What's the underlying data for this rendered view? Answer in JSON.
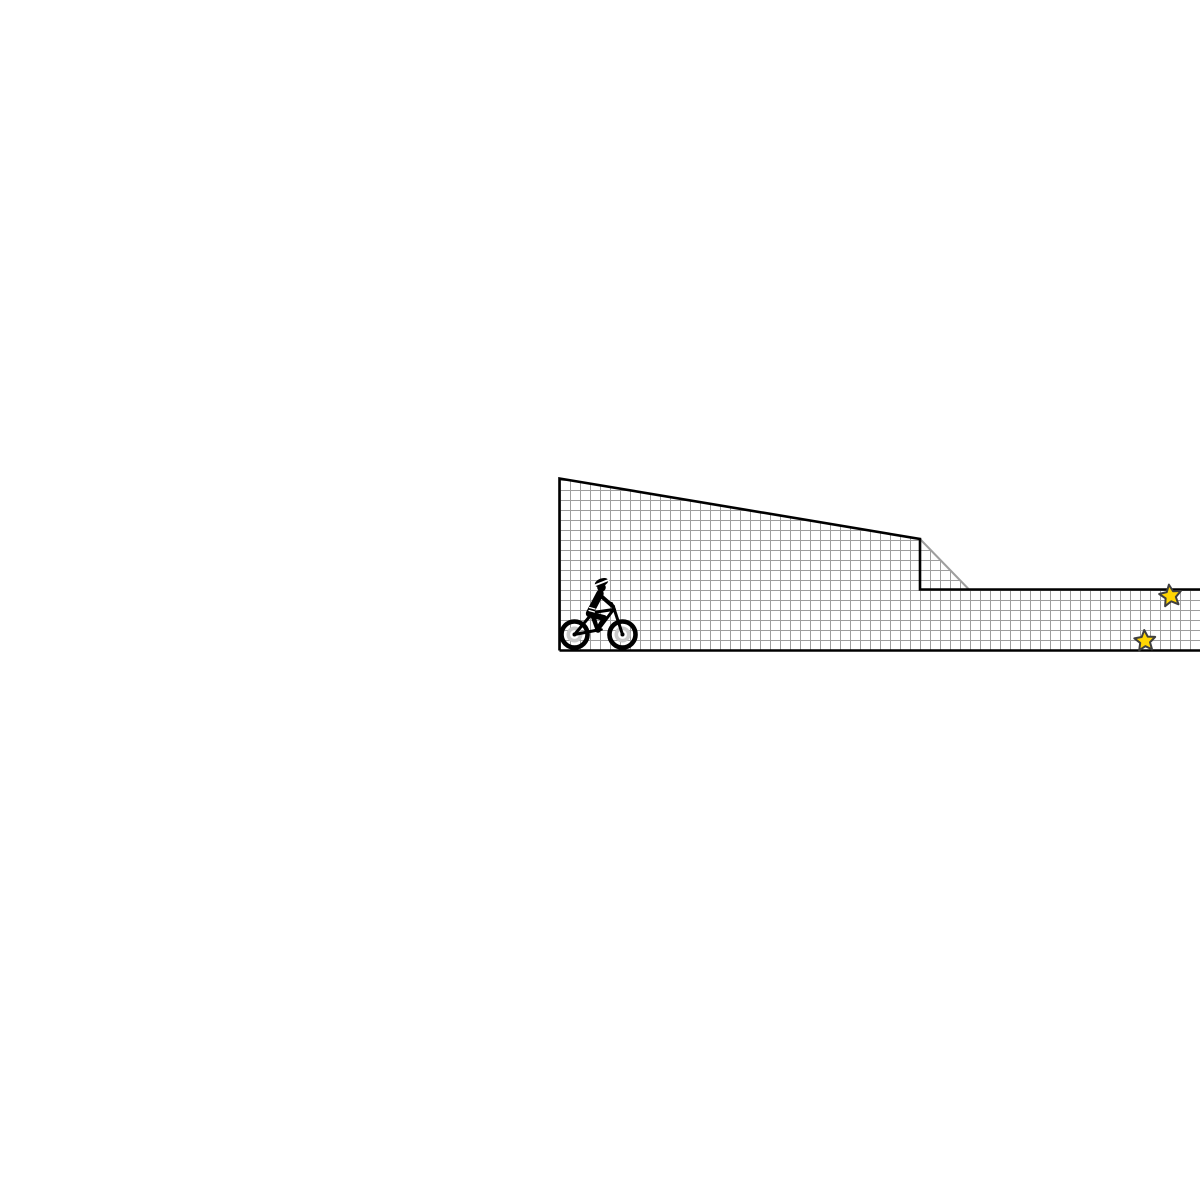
{
  "scene": {
    "width": 1200,
    "height": 1200,
    "background_color": "#ffffff",
    "terrain": {
      "grid_size": 10,
      "grid_line_color": "#9e9e9e",
      "grid_line_width": 2,
      "fill_color": "#ffffff",
      "outline_color": "#000000",
      "outline_width": 2.6,
      "surface_points": "559.5,478.5 920,539 969,589.5 1200,589.5 1200,650.5 559.5,650.5",
      "outline_path": "M 559.5 650.5 L 559.5 478.5 L 920 539 L 920 589.5 L 1200 589.5 M 559.5 650.5 L 1200 650.5",
      "texture_edge": {
        "x1": 920,
        "y1": 539,
        "x2": 969,
        "y2": 589.5
      }
    },
    "stars": {
      "fill_color": "#ffd503",
      "stroke_color": "#3f3f3f",
      "stroke_width": 2,
      "inner_ratio": 0.47,
      "items": [
        {
          "name": "star-upper",
          "cx": 1170.5,
          "cy": 596,
          "outer_r": 11.5,
          "rotation": -8
        },
        {
          "name": "star-lower",
          "cx": 1145,
          "cy": 641,
          "outer_r": 11,
          "rotation": -4
        }
      ]
    },
    "rider": {
      "name": "cyclist",
      "parts": [
        {
          "name": "rear-wheel-tire",
          "type": "circle",
          "cx": 574.5,
          "cy": 634.5,
          "r": 13,
          "fill": "none",
          "stroke": "#000000",
          "width": 4.6
        },
        {
          "name": "front-wheel-tire",
          "type": "circle",
          "cx": 622.5,
          "cy": 634.5,
          "r": 13,
          "fill": "none",
          "stroke": "#000000",
          "width": 4.6
        },
        {
          "name": "rear-wheel-hub",
          "type": "circle",
          "cx": 574.5,
          "cy": 634.5,
          "r": 6.2,
          "fill": "#ffffff",
          "stroke": "#c9c9c9",
          "width": 3.6
        },
        {
          "name": "front-wheel-hub",
          "type": "circle",
          "cx": 622.5,
          "cy": 634.5,
          "r": 6.2,
          "fill": "#ffffff",
          "stroke": "#c9c9c9",
          "width": 3.6
        },
        {
          "name": "frame-chainstay",
          "type": "line",
          "x1": 574.5,
          "y1": 634.5,
          "x2": 598,
          "y2": 630,
          "stroke": "#000000",
          "width": 3
        },
        {
          "name": "frame-seatstay",
          "type": "line",
          "x1": 574.5,
          "y1": 634.5,
          "x2": 593,
          "y2": 612.5,
          "stroke": "#000000",
          "width": 3
        },
        {
          "name": "frame-seattube",
          "type": "line",
          "x1": 593,
          "y1": 612.5,
          "x2": 598,
          "y2": 630,
          "stroke": "#000000",
          "width": 3
        },
        {
          "name": "frame-downtube",
          "type": "line",
          "x1": 598,
          "y1": 630,
          "x2": 613.5,
          "y2": 609.5,
          "stroke": "#000000",
          "width": 3
        },
        {
          "name": "frame-toptube",
          "type": "line",
          "x1": 593,
          "y1": 612.5,
          "x2": 613.5,
          "y2": 609.5,
          "stroke": "#000000",
          "width": 3
        },
        {
          "name": "frame-fork",
          "type": "line",
          "x1": 613.5,
          "y1": 607,
          "x2": 622.5,
          "y2": 634.5,
          "stroke": "#000000",
          "width": 3
        },
        {
          "name": "handlebar",
          "type": "line",
          "x1": 611.5,
          "y1": 603.5,
          "x2": 614.5,
          "y2": 609.5,
          "stroke": "#000000",
          "width": 3
        },
        {
          "name": "crank",
          "type": "circle",
          "cx": 598,
          "cy": 630,
          "r": 2.8,
          "fill": "#000000",
          "stroke": "none",
          "width": 0
        },
        {
          "name": "rear-axle",
          "type": "circle",
          "cx": 574.5,
          "cy": 634.5,
          "r": 2,
          "fill": "#000000",
          "stroke": "none",
          "width": 0
        },
        {
          "name": "front-axle",
          "type": "circle",
          "cx": 622.5,
          "cy": 634.5,
          "r": 2,
          "fill": "#000000",
          "stroke": "none",
          "width": 0
        },
        {
          "name": "rider-rear-leg",
          "type": "line",
          "x1": 592,
          "y1": 616,
          "x2": 596.5,
          "y2": 628.5,
          "stroke": "#000000",
          "width": 3
        },
        {
          "name": "rider-thigh",
          "type": "line",
          "x1": 590.5,
          "y1": 614.5,
          "x2": 604,
          "y2": 618,
          "stroke": "#000000",
          "width": 6
        },
        {
          "name": "rider-shin",
          "type": "line",
          "x1": 604,
          "y1": 618,
          "x2": 597.5,
          "y2": 629,
          "stroke": "#000000",
          "width": 4
        },
        {
          "name": "rider-foot",
          "type": "line",
          "x1": 594.5,
          "y1": 630.5,
          "x2": 601.5,
          "y2": 629.5,
          "stroke": "#000000",
          "width": 2.6
        },
        {
          "name": "rider-torso",
          "type": "line",
          "x1": 589.5,
          "y1": 613.5,
          "x2": 600,
          "y2": 593.5,
          "stroke": "#000000",
          "width": 7.4
        },
        {
          "name": "jersey-stripe-1",
          "type": "line",
          "x1": 589.5,
          "y1": 607.5,
          "x2": 595,
          "y2": 609,
          "stroke": "#ffffff",
          "width": 1.2
        },
        {
          "name": "jersey-stripe-2",
          "type": "line",
          "x1": 589,
          "y1": 610.5,
          "x2": 594.5,
          "y2": 612,
          "stroke": "#ffffff",
          "width": 1.2
        },
        {
          "name": "rider-arm",
          "type": "line",
          "x1": 600.5,
          "y1": 595.5,
          "x2": 613,
          "y2": 606.5,
          "stroke": "#000000",
          "width": 4
        },
        {
          "name": "rider-head",
          "type": "circle",
          "cx": 601.5,
          "cy": 587.5,
          "r": 4.3,
          "fill": "#000000",
          "stroke": "none",
          "width": 0
        },
        {
          "name": "rider-helmet",
          "type": "ellipse",
          "cx": 601.5,
          "cy": 582.5,
          "rx": 7,
          "ry": 4,
          "rotation": -22,
          "fill": "#000000",
          "stroke": "none",
          "width": 0
        },
        {
          "name": "helmet-band",
          "type": "line",
          "x1": 594.5,
          "y1": 585.5,
          "x2": 608.5,
          "y2": 580,
          "stroke": "#ffffff",
          "width": 1.8
        }
      ]
    }
  }
}
